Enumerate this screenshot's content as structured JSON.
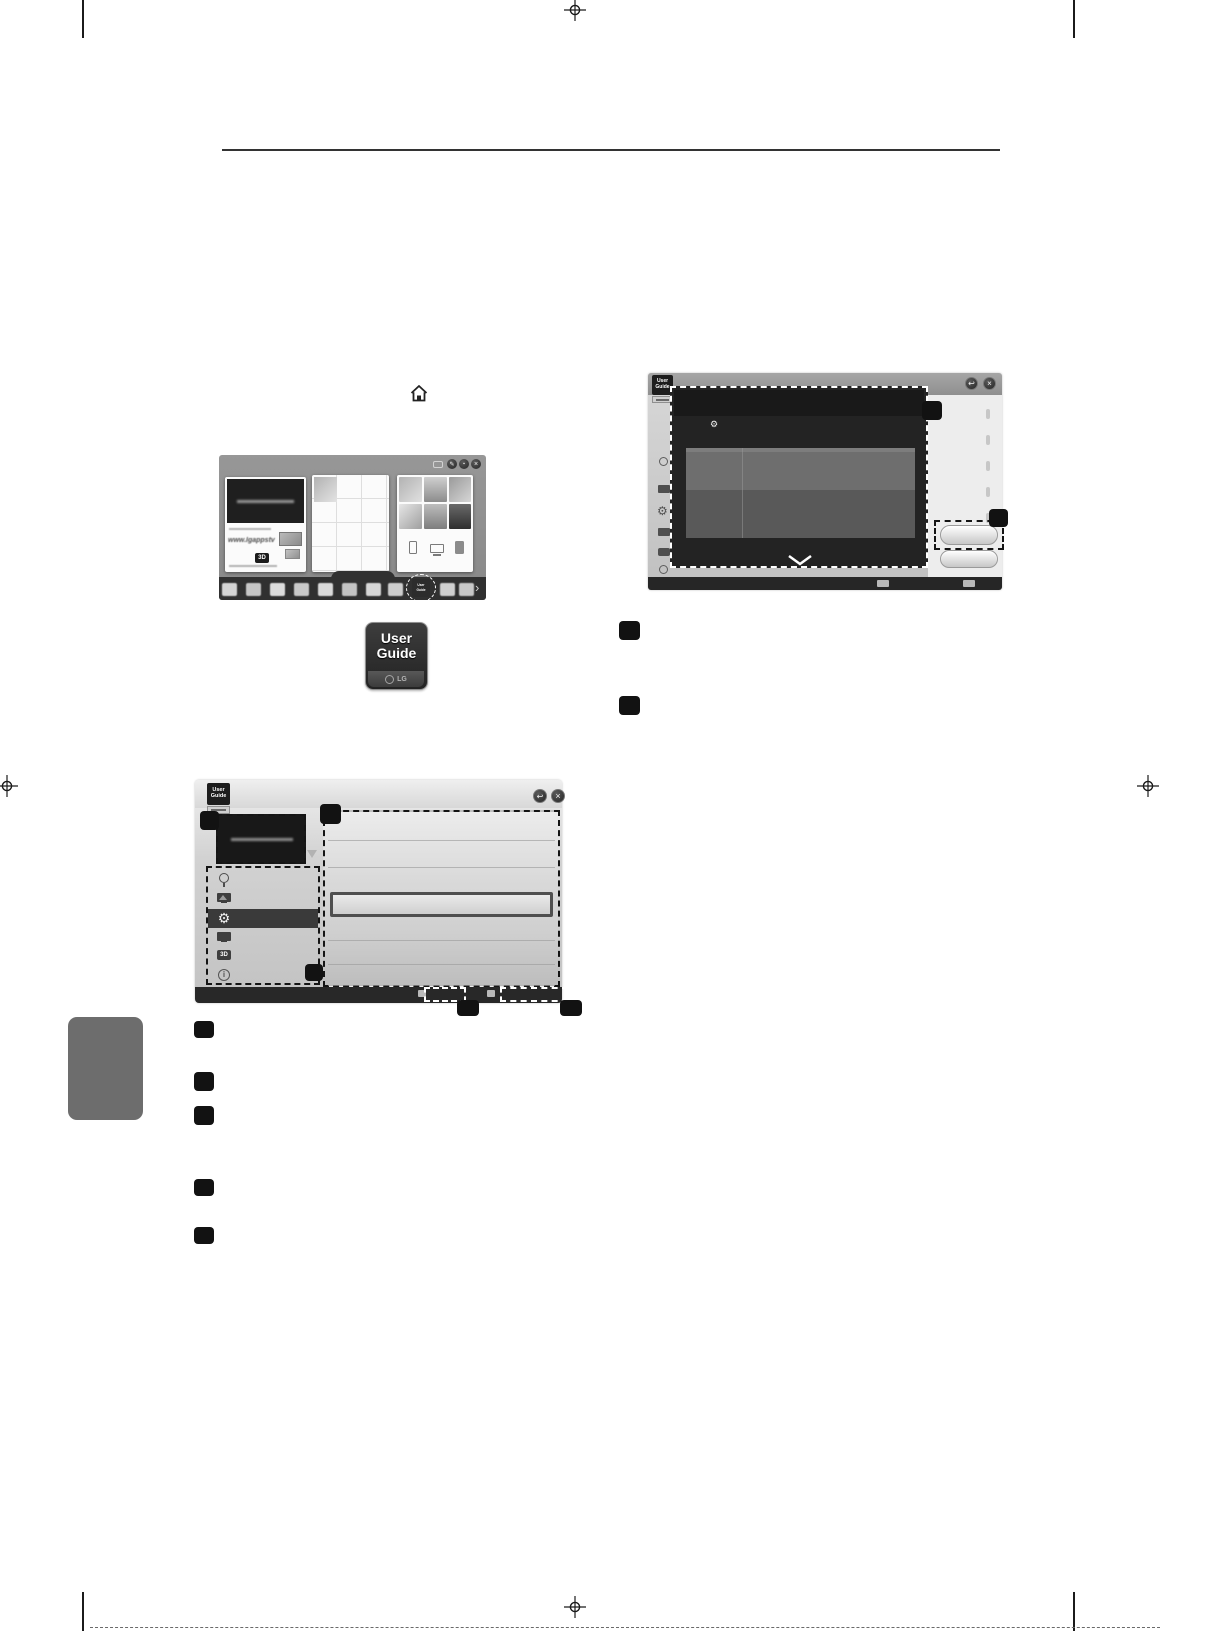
{
  "page": {
    "background": "#ffffff",
    "ink": "#1b1b1b"
  },
  "instruction": {
    "home_icon": "home"
  },
  "home_screen_shot": {
    "topbar_buttons": {
      "edit_glyph": "✎",
      "chat_glyph": "▪",
      "close_glyph": "×"
    },
    "premium_card": {
      "promo_url": "www.lgappstv",
      "badge_3d": "3D"
    },
    "launcher": {
      "highlight_app_line1": "User",
      "highlight_app_line2": "Guide",
      "more_glyph": "›"
    }
  },
  "app_icon": {
    "line1": "User",
    "line2": "Guide",
    "brand": "LG"
  },
  "guide_window": {
    "badge_line1": "User",
    "badge_line2": "Guide",
    "back_glyph": "↩",
    "close_glyph": "×",
    "gear_glyph": "⚙",
    "threed_label": "3D",
    "info_glyph": "i"
  },
  "overlay_window": {
    "badge_line1": "User",
    "badge_line2": "Guide",
    "back_glyph": "↩",
    "close_glyph": "×",
    "bullet_glyph": "⚙"
  },
  "colors": {
    "callout": "#121212",
    "dark_bar": "#282828",
    "overlay_bg": "#232323",
    "window_gray": "#c9c9c9",
    "side_tab": "#6d6d6d"
  }
}
